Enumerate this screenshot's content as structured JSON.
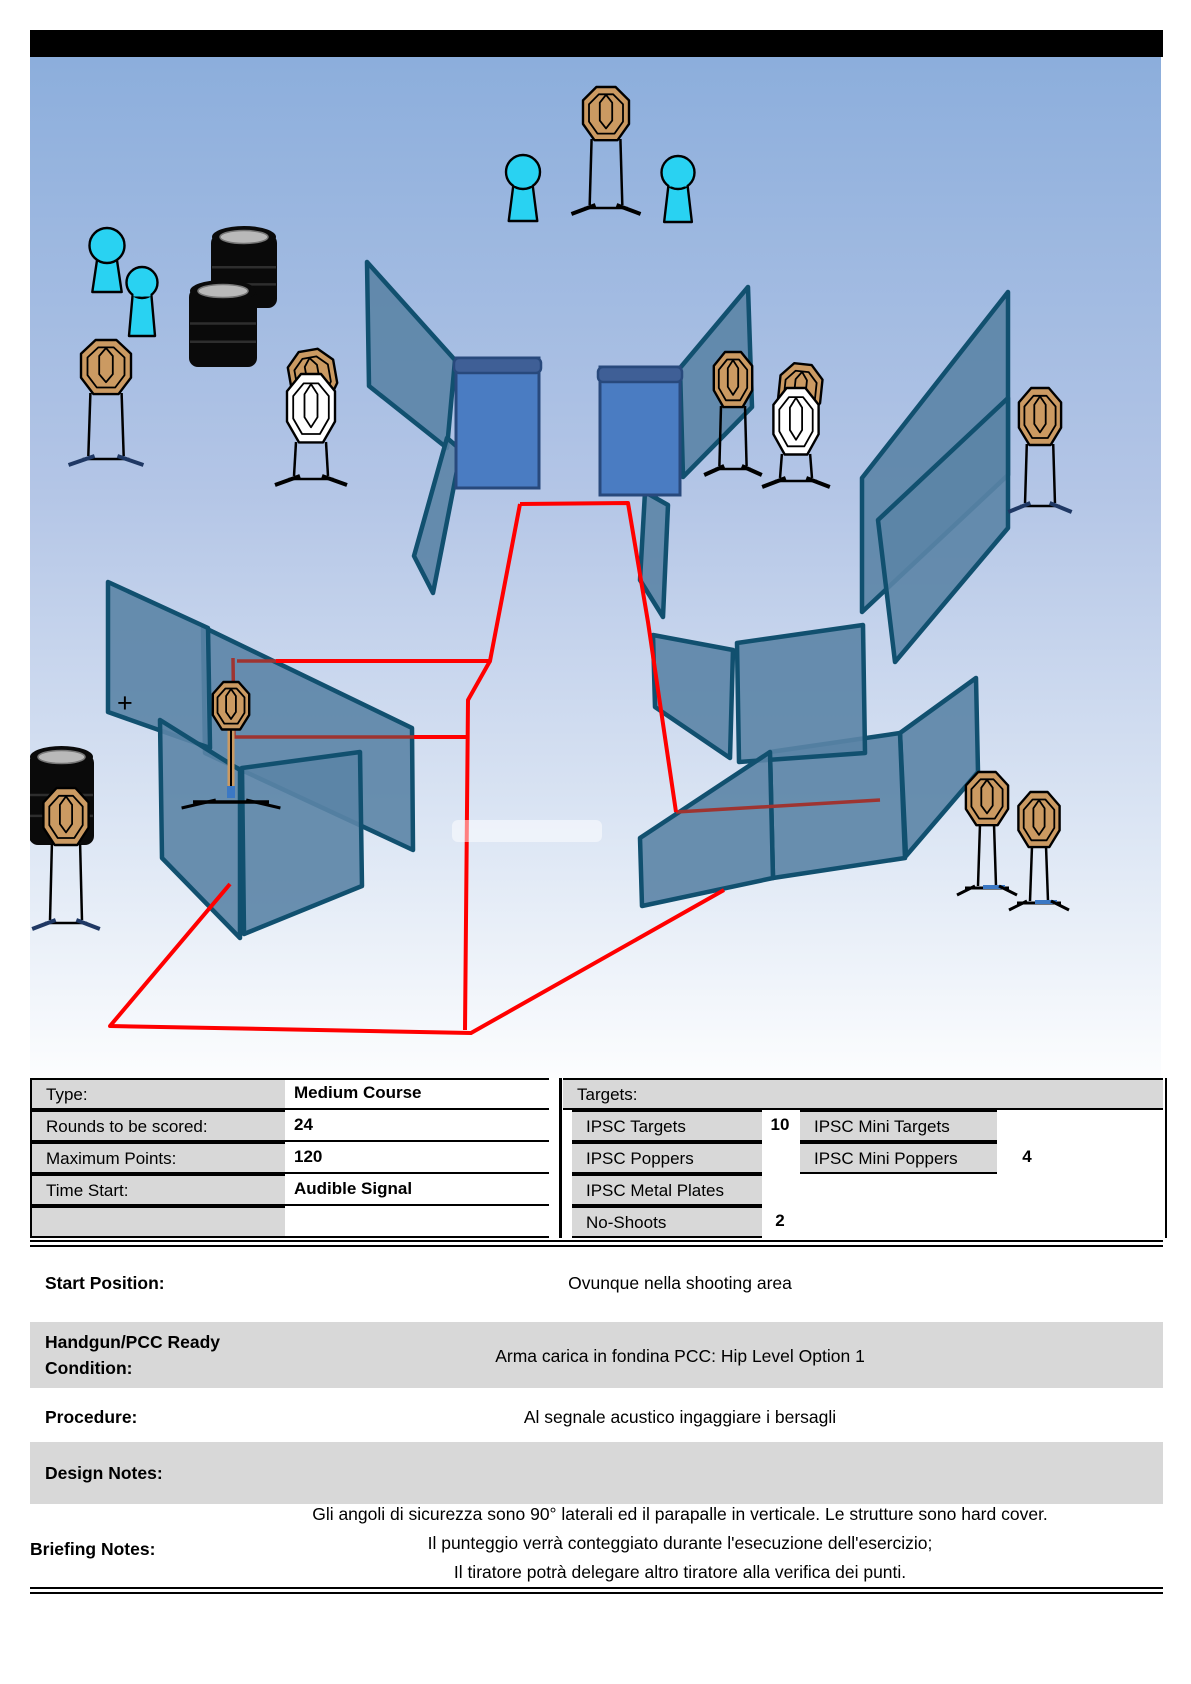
{
  "title_bar": {
    "color": "#000000"
  },
  "stage": {
    "bg_gradient": [
      "#8CAEDC",
      "#B3C5E6",
      "#DFE8F5",
      "#FCFDFE"
    ],
    "colors": {
      "wall_fill": "#5B84A6",
      "wall_stroke": "#11506F",
      "panel_fill": "#4A7CC2",
      "panel_cap": "#3F5F96",
      "panel_stroke": "#28497C",
      "target_fill": "#CB9A62",
      "noshoot_fill": "#FFFFFF",
      "popper_fill": "#29D2F2",
      "barrel_fill": "#0A0A0A",
      "barrel_top": "#B9B9B9",
      "fault_line": "#FF0000",
      "fault_line_covered": "#9E3431",
      "stand_navy": "#1F3864",
      "stand_blue": "#3B78C4"
    },
    "plus_marker": "+",
    "plus_pos": [
      117,
      712
    ],
    "walls": [
      [
        680,
        368,
        748,
        287,
        752,
        407,
        683,
        477
      ],
      [
        645,
        492,
        668,
        505,
        663,
        617,
        640,
        580
      ],
      [
        367,
        262,
        455,
        360,
        447,
        448,
        369,
        386
      ],
      [
        447,
        438,
        461,
        450,
        433,
        593,
        414,
        556
      ],
      [
        203,
        627,
        412,
        728,
        413,
        850,
        205,
        753
      ],
      [
        108,
        582,
        208,
        628,
        210,
        748,
        108,
        712
      ],
      [
        160,
        720,
        240,
        770,
        240,
        938,
        162,
        858
      ],
      [
        242,
        768,
        360,
        752,
        362,
        886,
        244,
        934
      ],
      [
        862,
        478,
        1008,
        292,
        1008,
        475,
        862,
        612
      ],
      [
        878,
        520,
        1008,
        398,
        1008,
        528,
        895,
        662
      ],
      [
        653,
        635,
        733,
        650,
        730,
        758,
        655,
        707
      ],
      [
        900,
        733,
        976,
        678,
        978,
        772,
        906,
        856
      ],
      [
        770,
        752,
        900,
        733,
        905,
        858,
        773,
        878
      ],
      [
        737,
        643,
        863,
        625,
        865,
        753,
        739,
        762
      ],
      [
        640,
        838,
        770,
        752,
        773,
        878,
        642,
        906
      ]
    ],
    "panels": [
      {
        "x": 456,
        "y": 358,
        "w": 83,
        "h": 130
      },
      {
        "x": 600,
        "y": 367,
        "w": 80,
        "h": 128
      }
    ],
    "red_lines": [
      [
        520,
        504,
        628,
        503,
        648,
        622,
        676,
        812
      ],
      [
        276,
        661,
        490,
        661,
        520,
        504
      ],
      [
        490,
        661,
        468,
        700,
        465,
        1030
      ],
      [
        414,
        737,
        468,
        737
      ],
      [
        724,
        890,
        471,
        1033,
        110,
        1026,
        230,
        884
      ]
    ],
    "maroon_lines": [
      [
        233,
        658,
        234,
        737,
        414,
        737
      ],
      [
        237,
        661,
        276,
        661
      ],
      [
        676,
        812,
        880,
        800
      ]
    ],
    "targets": [
      {
        "cx": 606,
        "y": 87,
        "w": 48,
        "h": 56,
        "stand": "legs",
        "to": 205,
        "feet": "black"
      },
      {
        "cx": 106,
        "y": 340,
        "w": 52,
        "h": 57,
        "stand": "legs",
        "to": 456,
        "feet": "navy"
      },
      {
        "cx": 313,
        "y": 350,
        "w": 48,
        "h": 56,
        "rot": -10
      },
      {
        "cx": 733,
        "y": 352,
        "w": 40,
        "h": 58,
        "stand": "legs",
        "to": 466,
        "feet": "black"
      },
      {
        "cx": 800,
        "y": 364,
        "w": 44,
        "h": 56,
        "rot": 6
      },
      {
        "cx": 1040,
        "y": 388,
        "w": 44,
        "h": 60,
        "stand": "legs",
        "to": 503,
        "feet": "navy"
      },
      {
        "cx": 231,
        "y": 682,
        "w": 38,
        "h": 50,
        "stand": "stick",
        "to": 798
      },
      {
        "cx": 66,
        "y": 788,
        "w": 47,
        "h": 60,
        "stand": "legs",
        "to": 920,
        "feet": "navy"
      },
      {
        "cx": 987,
        "y": 772,
        "w": 44,
        "h": 56,
        "stand": "sticks",
        "to": 886
      },
      {
        "cx": 1039,
        "y": 792,
        "w": 43,
        "h": 58,
        "stand": "sticks",
        "to": 901
      }
    ],
    "noshoots": [
      {
        "cx": 311,
        "y": 374,
        "w": 50,
        "h": 72,
        "stand": "legs",
        "to": 476,
        "feet": "black"
      },
      {
        "cx": 796,
        "y": 388,
        "w": 47,
        "h": 70,
        "stand": "legs",
        "to": 478,
        "feet": "black"
      }
    ],
    "poppers": [
      {
        "cx": 523,
        "y": 155,
        "w": 34,
        "h": 66
      },
      {
        "cx": 678,
        "y": 156,
        "w": 33,
        "h": 66
      },
      {
        "cx": 107,
        "y": 228,
        "w": 35,
        "h": 64
      },
      {
        "cx": 142,
        "y": 267,
        "w": 31,
        "h": 69
      }
    ],
    "barrels": [
      {
        "x": 211,
        "y": 226,
        "w": 66,
        "h": 74
      },
      {
        "x": 189,
        "y": 280,
        "w": 68,
        "h": 79
      },
      {
        "x": 29,
        "y": 746,
        "w": 65,
        "h": 91
      }
    ],
    "white_streak": {
      "x": 452,
      "y": 820,
      "w": 150,
      "h": 22
    }
  },
  "info_table": {
    "left_rows": [
      {
        "label": "Type:",
        "value": "Medium Course"
      },
      {
        "label": "Rounds to be scored:",
        "value": "24"
      },
      {
        "label": "Maximum Points:",
        "value": "120"
      },
      {
        "label": "Time Start:",
        "value": "Audible Signal"
      },
      {
        "label": "",
        "value": ""
      }
    ],
    "right_header": "Targets:",
    "right_rows": [
      {
        "label1": "IPSC Targets",
        "count1": "10",
        "label2": "IPSC Mini Targets",
        "count2": ""
      },
      {
        "label1": "IPSC Poppers",
        "count1": "",
        "label2": "IPSC Mini Poppers",
        "count2": "4"
      },
      {
        "label1": "IPSC Metal Plates",
        "count1": "",
        "label2": "",
        "count2": ""
      },
      {
        "label1": "No-Shoots",
        "count1": "2",
        "label2": "",
        "count2": ""
      }
    ]
  },
  "sections": [
    {
      "label": "Start Position:",
      "value": "Ovunque nella shooting area"
    },
    {
      "label": "Handgun/PCC Ready Condition:",
      "value": "Arma carica in fondina PCC: Hip Level Option 1"
    },
    {
      "label": "Procedure:",
      "value": "Al segnale acustico ingaggiare i bersagli"
    },
    {
      "label": "Design Notes:",
      "value": ""
    },
    {
      "label": "Briefing Notes:",
      "lines": [
        "Gli angoli di sicurezza sono 90° laterali ed il parapalle in verticale. Le strutture sono hard cover.",
        "Il punteggio verrà conteggiato durante l'esecuzione dell'esercizio;",
        "Il tiratore potrà delegare altro tiratore alla verifica dei punti."
      ]
    }
  ]
}
